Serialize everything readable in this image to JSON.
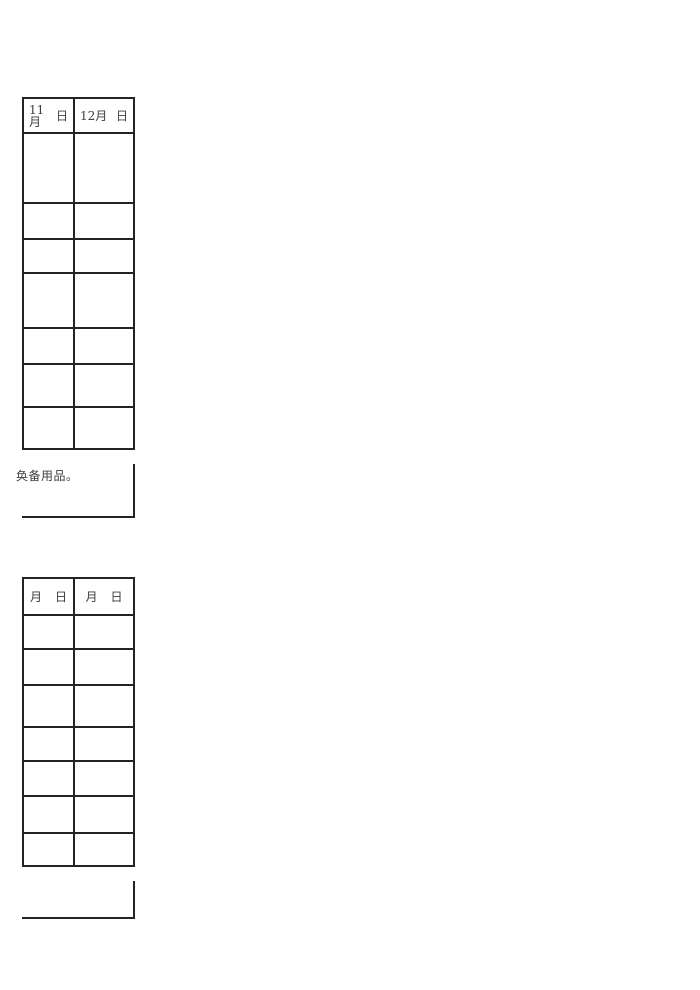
{
  "table1": {
    "headers": [
      {
        "month": "11月",
        "day": "日"
      },
      {
        "month": "12月",
        "day": "日"
      }
    ],
    "rows": [
      [
        "",
        ""
      ],
      [
        "",
        ""
      ],
      [
        "",
        ""
      ],
      [
        "",
        ""
      ],
      [
        "",
        ""
      ],
      [
        "",
        ""
      ],
      [
        "",
        ""
      ]
    ]
  },
  "note_text": "奂备用品。",
  "table2": {
    "headers": [
      {
        "month": "月",
        "day": "日"
      },
      {
        "month": "月",
        "day": "日"
      }
    ],
    "rows": [
      [
        "",
        ""
      ],
      [
        "",
        ""
      ],
      [
        "",
        ""
      ],
      [
        "",
        ""
      ],
      [
        "",
        ""
      ],
      [
        "",
        ""
      ],
      [
        "",
        ""
      ]
    ]
  }
}
